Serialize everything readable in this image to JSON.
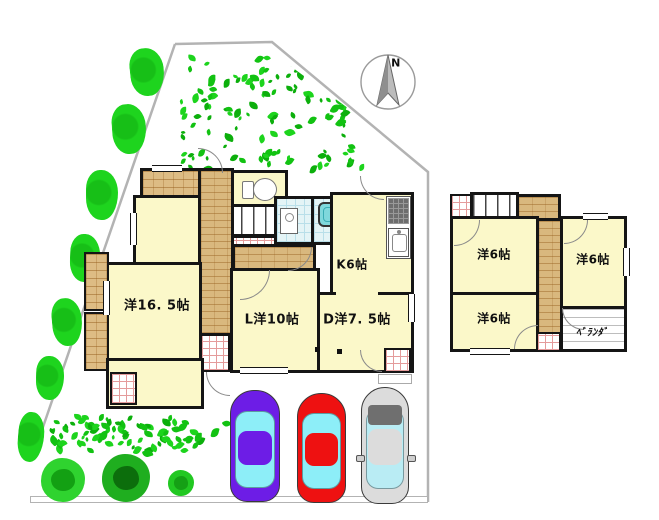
{
  "compass": {
    "label": "N"
  },
  "floor1": {
    "rooms": {
      "western": {
        "label": "洋16. 5帖"
      },
      "living": {
        "label": "L洋10帖"
      },
      "dining": {
        "label": "D洋7. 5帖"
      },
      "kitchen": {
        "label": "K6帖"
      }
    }
  },
  "floor2": {
    "rooms": {
      "bedroom_nw": {
        "label": "洋6帖"
      },
      "bedroom_sw": {
        "label": "洋6帖"
      },
      "bedroom_e": {
        "label": "洋6帖"
      },
      "veranda": {
        "label": "ﾍﾞﾗﾝﾀﾞ"
      }
    }
  },
  "colors": {
    "wall": "#151515",
    "room_fill": "#fbf8c9",
    "wood": "#d9b87e",
    "tile_blue": "#e4f4f6",
    "bathtub": "#7fd8dc",
    "boundary": "#b3b3b3",
    "leaf_greens": [
      "#12c212",
      "#1dd41d",
      "#0caf0c"
    ],
    "car_purple": "#6d1de6",
    "car_red": "#ee1111",
    "car_silver": "#dcdcdc",
    "car_glass": "#8deef8"
  },
  "decor": {
    "foliage": [
      {
        "name": "foliage-top",
        "x": 178,
        "y": 52,
        "w": 190,
        "h": 122,
        "count": 135,
        "clip": "polygon(0% 0%, 49% 0%, 100% 58%, 100% 100%, 0% 100%)"
      },
      {
        "name": "foliage-bottom",
        "x": 48,
        "y": 414,
        "w": 190,
        "h": 44,
        "count": 85,
        "clip": ""
      }
    ],
    "bushes": [
      {
        "x": 130,
        "y": 48,
        "w": 34,
        "h": 48
      },
      {
        "x": 112,
        "y": 104,
        "w": 34,
        "h": 50
      },
      {
        "x": 86,
        "y": 170,
        "w": 32,
        "h": 50
      },
      {
        "x": 70,
        "y": 234,
        "w": 30,
        "h": 48
      },
      {
        "x": 52,
        "y": 298,
        "w": 30,
        "h": 48
      },
      {
        "x": 36,
        "y": 356,
        "w": 28,
        "h": 44
      },
      {
        "x": 18,
        "y": 412,
        "w": 26,
        "h": 50
      }
    ],
    "trees": [
      {
        "x": 41,
        "y": 458,
        "d": 44,
        "outer": "#2fd32f",
        "inner": "#13a013"
      },
      {
        "x": 102,
        "y": 454,
        "d": 48,
        "outer": "#1fae1f",
        "inner": "#0c6e0c"
      },
      {
        "x": 168,
        "y": 470,
        "d": 26,
        "outer": "#22c822",
        "inner": "#15a015"
      }
    ],
    "cars": [
      {
        "name": "car-purple",
        "x": 230,
        "y": 390,
        "w": 50,
        "h": 112,
        "body": "#6d1de6",
        "glass": "#8deef8",
        "silver": false
      },
      {
        "name": "car-red",
        "x": 297,
        "y": 393,
        "w": 49,
        "h": 110,
        "body": "#ee1111",
        "glass": "#8deef8",
        "silver": false
      },
      {
        "name": "car-silver",
        "x": 361,
        "y": 387,
        "w": 48,
        "h": 117,
        "body": "#dcdcdc",
        "glass": "#b9ecf4",
        "silver": true
      }
    ]
  }
}
